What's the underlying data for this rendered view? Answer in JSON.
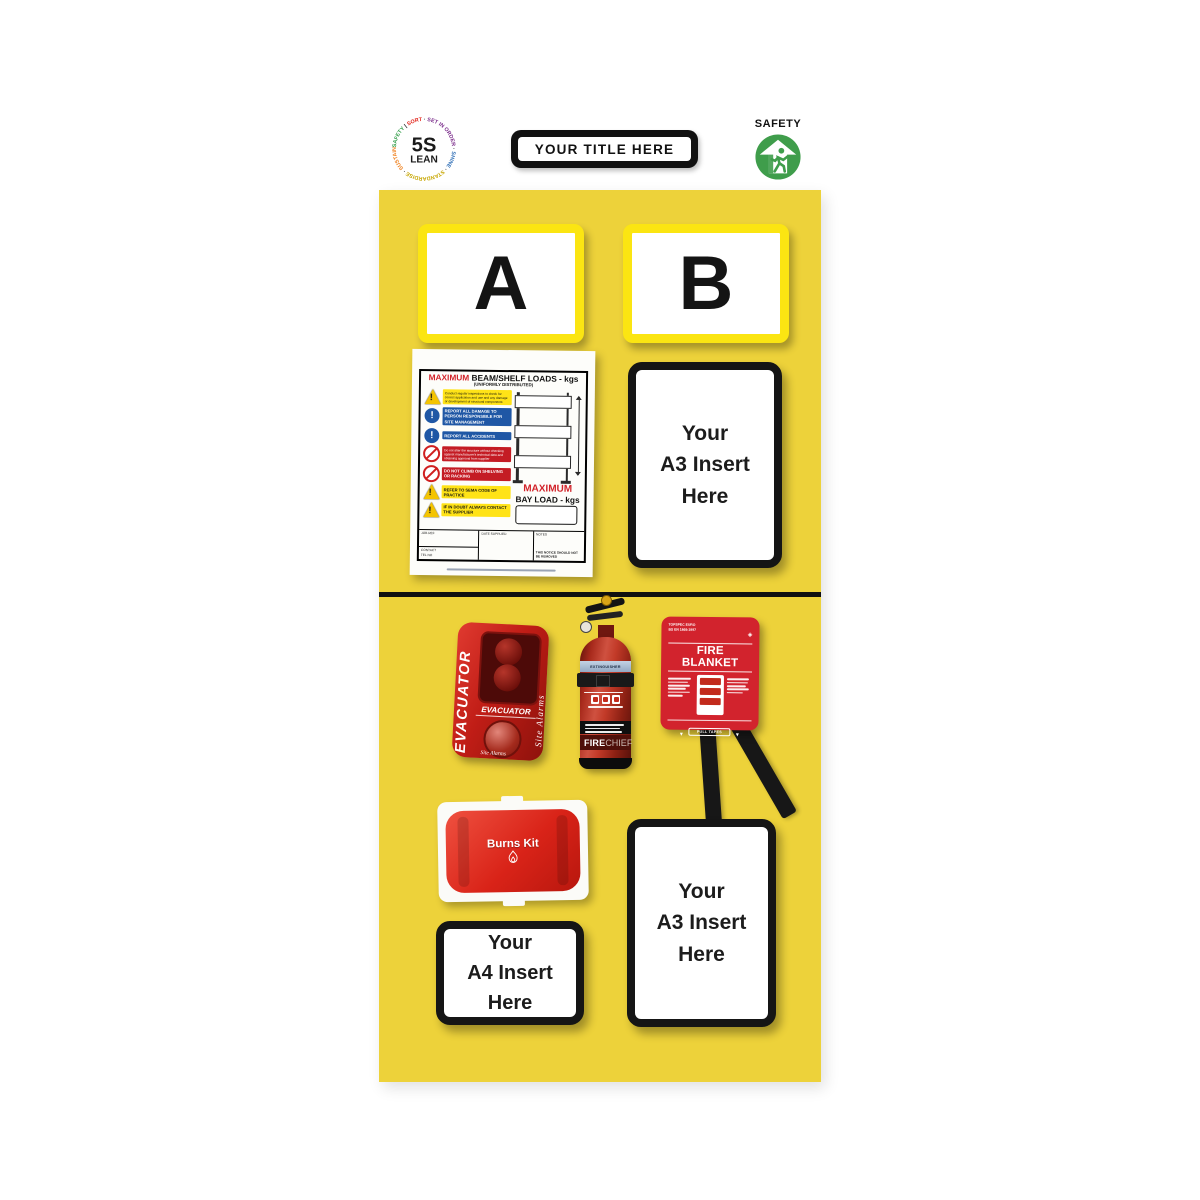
{
  "colors": {
    "board_yellow": "#edd23a",
    "bay_border_yellow": "#fbe512",
    "safety_green": "#3f9d4b",
    "equipment_red": "#d2232d",
    "notice_red": "#d2232a",
    "notice_blue": "#1f57a5"
  },
  "header": {
    "logo": {
      "line1": "5S",
      "line2": "LEAN",
      "ring": [
        {
          "text": "SAFETY ",
          "color": "#2e9b45"
        },
        {
          "text": "| ",
          "color": "#1a1a1a"
        },
        {
          "text": "SORT ",
          "color": "#e2231a"
        },
        {
          "text": "· ",
          "color": "#1a1a1a"
        },
        {
          "text": "SET IN ORDER ",
          "color": "#7b2d8b"
        },
        {
          "text": "· ",
          "color": "#1a1a1a"
        },
        {
          "text": "SHINE ",
          "color": "#2b6cb5"
        },
        {
          "text": "· ",
          "color": "#1a1a1a"
        },
        {
          "text": "STANDARDISE ",
          "color": "#c7a600"
        },
        {
          "text": "· ",
          "color": "#1a1a1a"
        },
        {
          "text": "SUSTAIN ",
          "color": "#ef7d17"
        },
        {
          "text": "·",
          "color": "#1a1a1a"
        }
      ]
    },
    "title": "YOUR TITLE HERE",
    "safety_badge_label": "SAFETY"
  },
  "board": {
    "bay_labels": [
      "A",
      "B"
    ],
    "rack_notice": {
      "title_red": "MAXIMUM",
      "title_black": "BEAM/SHELF LOADS - kgs",
      "subtitle": "(UNIFORMLY DISTRIBUTED)",
      "rows": [
        {
          "type": "warning",
          "text": "Conduct regular inspections to check for correct application and use and any damage or development of structural components"
        },
        {
          "type": "mandatory",
          "text": "REPORT ALL DAMAGE TO PERSON RESPONSIBLE FOR SITE MANAGEMENT"
        },
        {
          "type": "mandatory",
          "text": "REPORT ALL ACCIDENTS"
        },
        {
          "type": "prohibition",
          "text": "Do not alter the structure without checking against manufacturer's technical data and obtaining approval from supplier"
        },
        {
          "type": "prohibition",
          "text": "DO NOT CLIMB ON SHELVING OR RACKING"
        },
        {
          "type": "warning",
          "text": "REFER TO SEMA CODE OF PRACTICE"
        },
        {
          "type": "warning",
          "text": "IF IN DOUBT ALWAYS CONTACT THE SUPPLIER"
        }
      ],
      "bay_load_red": "MAXIMUM",
      "bay_load_black": "BAY LOAD - kgs",
      "form": {
        "job_ref": "JOB REF",
        "contact": "CONTACT",
        "tel_no": "TEL NO",
        "date_supplied": "DATE SUPPLIED",
        "notes": "NOTES",
        "warning": "THIS NOTICE SHOULD NOT BE REMOVED"
      }
    },
    "inserts": {
      "a3_top": {
        "lines": [
          "Your",
          "A3 Insert",
          "Here"
        ]
      },
      "a3_bottom": {
        "lines": [
          "Your",
          "A3 Insert",
          "Here"
        ]
      },
      "a4": {
        "lines": [
          "Your",
          "A4 Insert",
          "Here"
        ]
      }
    },
    "equipment": {
      "evacuator": {
        "side_label": "EVACUATOR",
        "front_label": "EVACUATOR",
        "brand_script": "Site Alarms"
      },
      "extinguisher": {
        "band_label": "EXTINGUISHER",
        "brand_bold": "FIRE",
        "brand_light": "CHIEF"
      },
      "fire_blanket": {
        "spec_line1": "TOPSPEC EURO",
        "spec_line2": "BS EN 1869:1997",
        "title": "FIRE BLANKET",
        "pull_tapes": "PULL TAPES"
      },
      "burns_kit": {
        "label": "Burns Kit"
      }
    }
  }
}
